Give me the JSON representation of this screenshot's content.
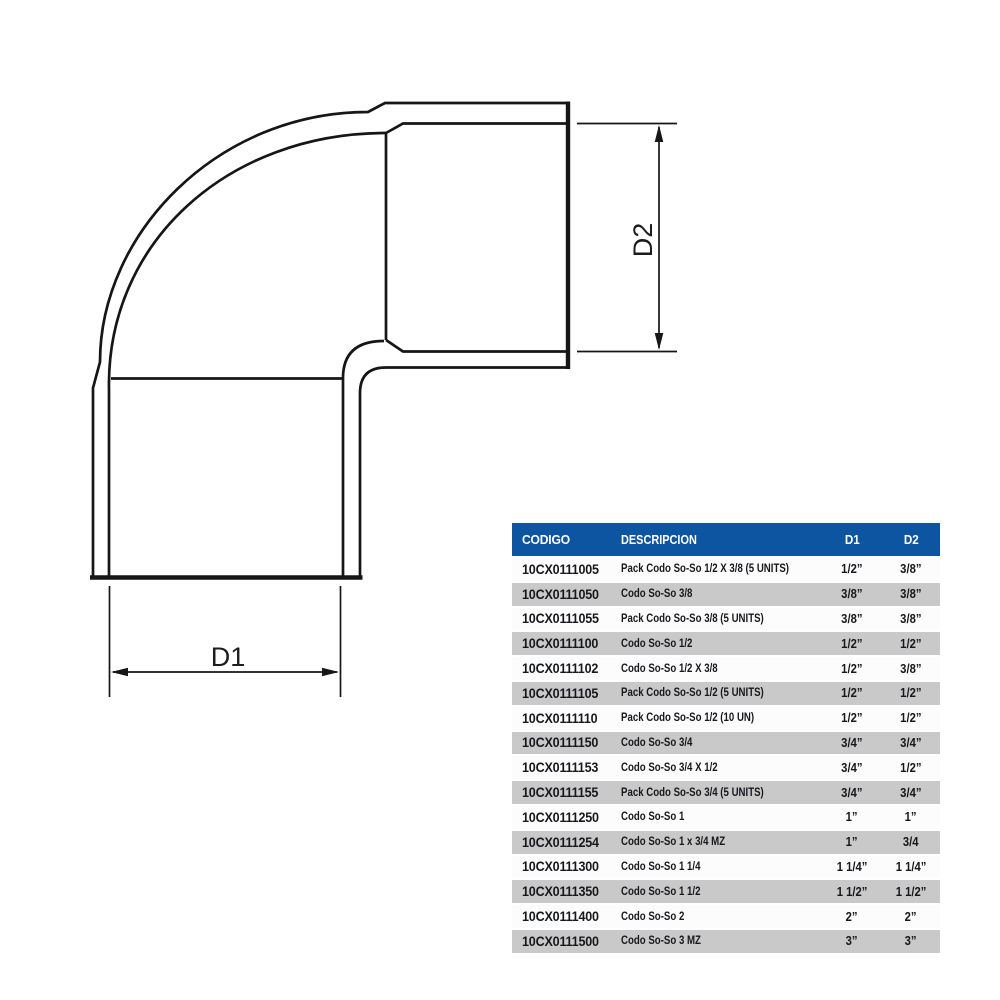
{
  "diagram": {
    "d1_label": "D1",
    "d2_label": "D2"
  },
  "table": {
    "headers": {
      "codigo": "CODIGO",
      "descripcion": "DESCRIPCION",
      "d1": "D1",
      "d2": "D2"
    },
    "colors": {
      "header_bg": "#0d54a1",
      "row_alt": "#c9c9c9",
      "row_base": "#fcfcfc",
      "header_text": "#ffffff"
    },
    "rows": [
      [
        "10CX0111005",
        "Pack Codo So-So 1/2 X 3/8 (5 UNITS)",
        "1/2”",
        "3/8”"
      ],
      [
        "10CX0111050",
        "Codo So-So 3/8",
        "3/8”",
        "3/8”"
      ],
      [
        "10CX0111055",
        "Pack Codo So-So 3/8 (5 UNITS)",
        "3/8”",
        "3/8”"
      ],
      [
        "10CX0111100",
        "Codo So-So 1/2",
        "1/2”",
        "1/2”"
      ],
      [
        "10CX0111102",
        "Codo So-So 1/2 X 3/8",
        "1/2”",
        "3/8”"
      ],
      [
        "10CX0111105",
        "Pack Codo So-So 1/2 (5 UNITS)",
        "1/2”",
        "1/2”"
      ],
      [
        "10CX0111110",
        "Pack Codo So-So 1/2 (10 UN)",
        "1/2”",
        "1/2”"
      ],
      [
        "10CX0111150",
        "Codo So-So 3/4",
        "3/4”",
        "3/4”"
      ],
      [
        "10CX0111153",
        "Codo So-So 3/4 X 1/2",
        "3/4”",
        "1/2”"
      ],
      [
        "10CX0111155",
        "Pack Codo So-So 3/4 (5 UNITS)",
        "3/4”",
        "3/4”"
      ],
      [
        "10CX0111250",
        "Codo So-So 1",
        "1”",
        "1”"
      ],
      [
        "10CX0111254",
        "Codo So-So 1 x 3/4 MZ",
        "1”",
        "3/4"
      ],
      [
        "10CX0111300",
        "Codo So-So 1 1/4",
        "1 1/4”",
        "1 1/4”"
      ],
      [
        "10CX0111350",
        "Codo So-So 1 1/2",
        "1 1/2”",
        "1 1/2”"
      ],
      [
        "10CX0111400",
        "Codo So-So 2",
        "2”",
        "2”"
      ],
      [
        "10CX0111500",
        "Codo So-So 3 MZ",
        "3”",
        "3”"
      ]
    ]
  }
}
